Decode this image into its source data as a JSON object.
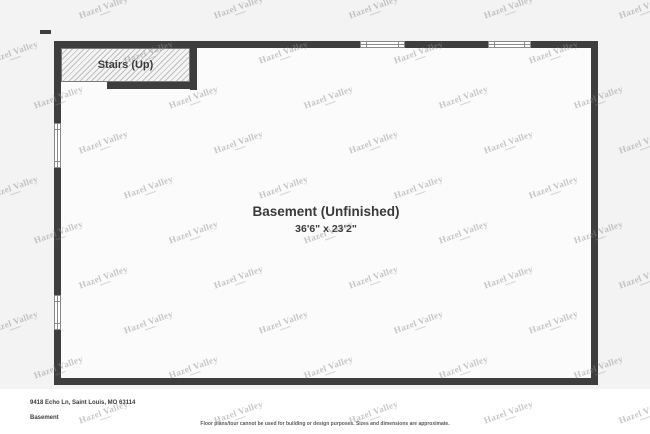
{
  "floor_plan": {
    "stairs_label": "Stairs (Up)",
    "room_name": "Basement (Unfinished)",
    "room_size": "36'6\" x 23'2\""
  },
  "footer": {
    "address": "9418 Echo Ln, Saint Louis, MO 63114",
    "level_label": "Basement",
    "disclaimer": "Floor plans/tour cannot be used for building or design purposes. Sizes and dimensions are approximate."
  },
  "watermark": {
    "text": "Hazel Valley"
  },
  "colors": {
    "wall": "#3e3e3e",
    "floor": "#fbfbfb",
    "background": "#f3f3f3",
    "footer_bg": "#ffffff",
    "label_text": "#3a3a3a",
    "watermark_text": "#8f8f8f"
  }
}
